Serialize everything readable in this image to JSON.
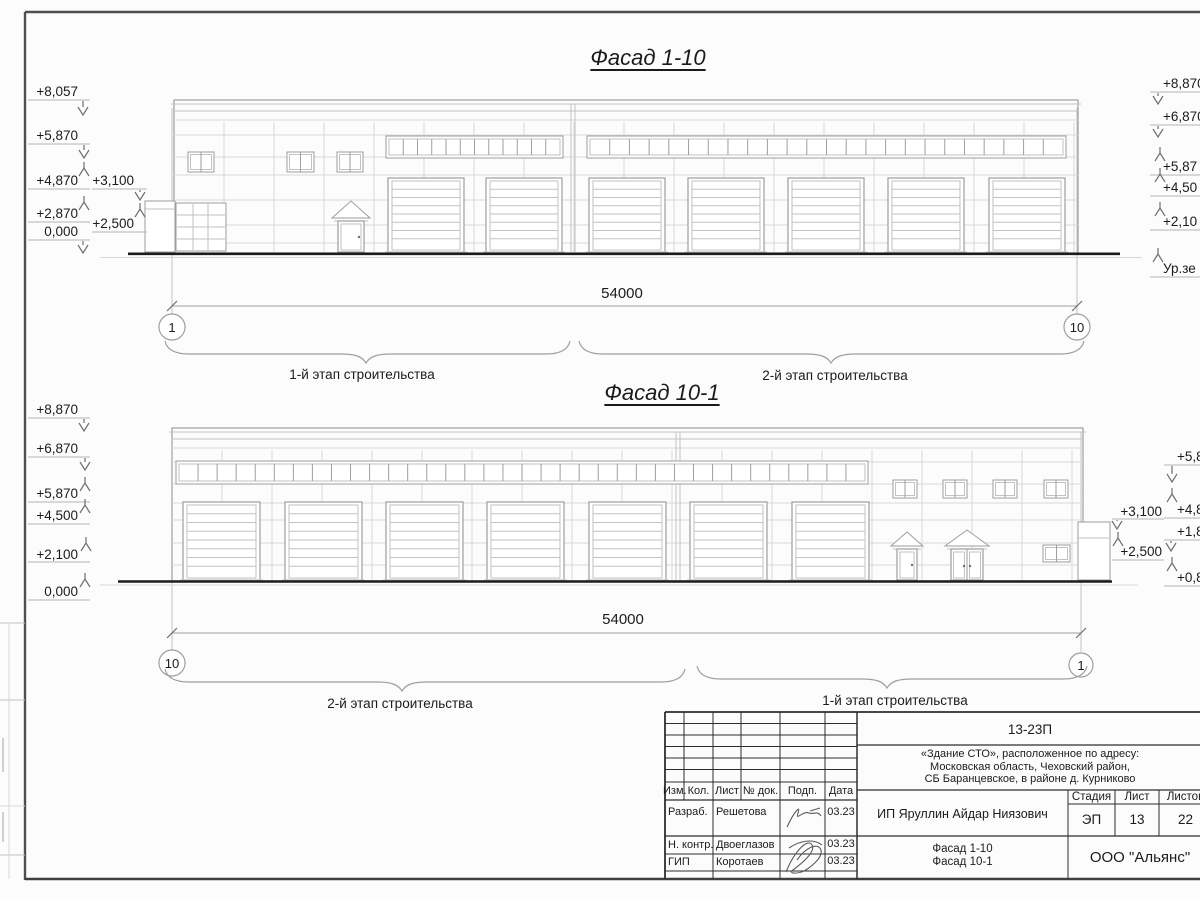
{
  "titles": {
    "facade1": "Фасад 1-10",
    "facade2": "Фасад 10-1"
  },
  "facade1": {
    "dim": "54000",
    "axis_left": "1",
    "axis_right": "10",
    "stage_left": "1-й этап строительства",
    "stage_right": "2-й этап строительства",
    "marks_left": [
      "+8,057",
      "+5,870",
      "+4,870",
      "+2,870",
      "0,000"
    ],
    "marks_inner": [
      "+3,100",
      "+2,500"
    ],
    "marks_right": [
      "+8,870",
      "+6,870",
      "+5,87",
      "+4,50",
      "+2,10",
      "Ур.зе"
    ]
  },
  "facade2": {
    "dim": "54000",
    "axis_left": "10",
    "axis_right": "1",
    "stage_left": "2-й этап строительства",
    "stage_right": "1-й этап строительства",
    "marks_left": [
      "+8,870",
      "+6,870",
      "+5,870",
      "+4,500",
      "+2,100",
      "0,000"
    ],
    "marks_inner": [
      "+3,100",
      "+2,500"
    ],
    "marks_right": [
      "+5,8",
      "+4,8",
      "+1,8",
      "+0,8"
    ]
  },
  "titleblock": {
    "doc_code": "13-23П",
    "project_lines": [
      "«Здание СТО», расположенное по адресу:",
      "Московская область, Чеховский район,",
      "СБ Баранцевское, в районе д. Курниково"
    ],
    "rev_headers": [
      "Изм.",
      "Кол.",
      "Лист",
      "№ док.",
      "Подп.",
      "Дата"
    ],
    "signers": [
      {
        "role": "Разраб.",
        "name": "Решетова",
        "date": "03.23"
      },
      {
        "role": "Н. контр.",
        "name": "Двоеглазов",
        "date": "03.23"
      },
      {
        "role": "ГИП",
        "name": "Коротаев",
        "date": "03.23"
      }
    ],
    "client": "ИП Яруллин Айдар Ниязович",
    "cols": {
      "stage_label": "Стадия",
      "sheet_label": "Лист",
      "sheets_label": "Листов",
      "stage": "ЭП",
      "sheet": "13",
      "sheets": "22"
    },
    "drawing_names": [
      "Фасад 1-10",
      "Фасад 10-1"
    ],
    "company": "ООО \"Альянс\""
  }
}
